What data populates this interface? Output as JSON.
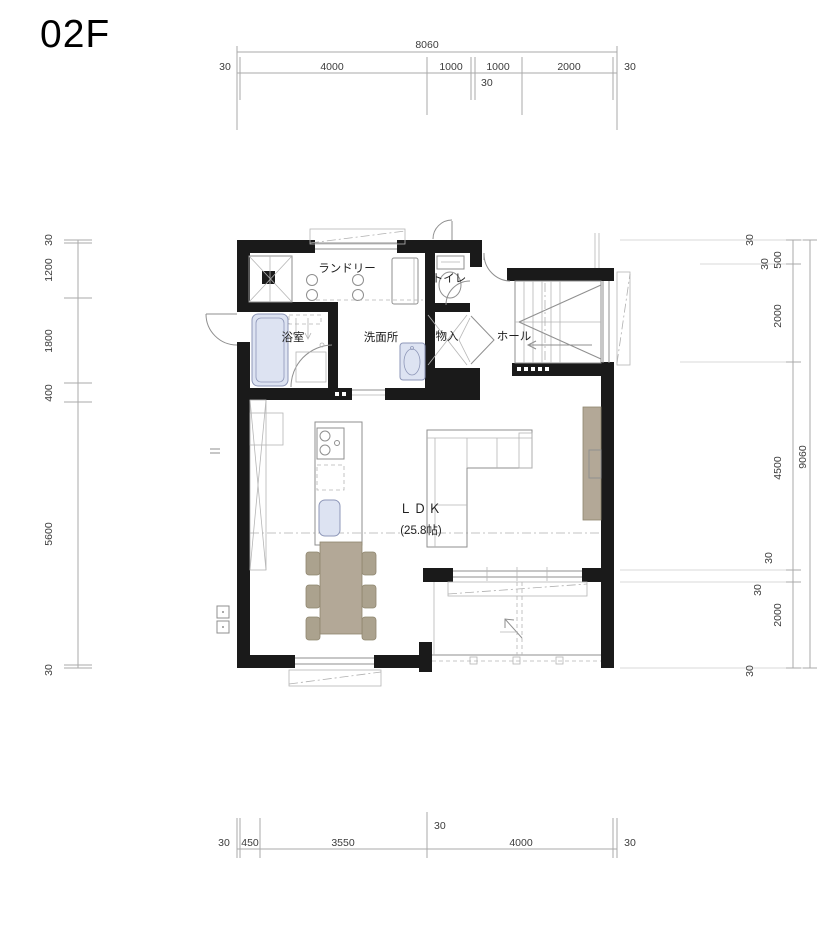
{
  "title": "02F",
  "rooms": {
    "laundry": "ランドリー",
    "toilet": "トイレ",
    "bath": "浴室",
    "washroom": "洗面所",
    "storage": "物入",
    "hall": "ホール",
    "ldk": "ＬＤＫ",
    "ldk_area": "(25.8帖)"
  },
  "dims": {
    "top": {
      "total": "8060",
      "segments": [
        "30",
        "4000",
        "1000",
        "1000",
        "2000",
        "30"
      ],
      "sub": "30"
    },
    "bottom": {
      "segments": [
        "30",
        "450",
        "3550",
        "4000",
        "30"
      ],
      "sub": "30"
    },
    "left": {
      "segments": [
        "30",
        "1200",
        "1800",
        "400",
        "5600",
        "30"
      ]
    },
    "right": {
      "total": "9060",
      "segments": [
        "30",
        "500",
        "2000",
        "4500",
        "2000",
        "30"
      ],
      "subs": [
        "30",
        "30",
        "30"
      ]
    }
  },
  "colors": {
    "wall": "#1a1a1a",
    "furniture_tan": "#b3a897",
    "fixture_blue": "#dde3f2",
    "line_gray": "#8f8f8f"
  }
}
